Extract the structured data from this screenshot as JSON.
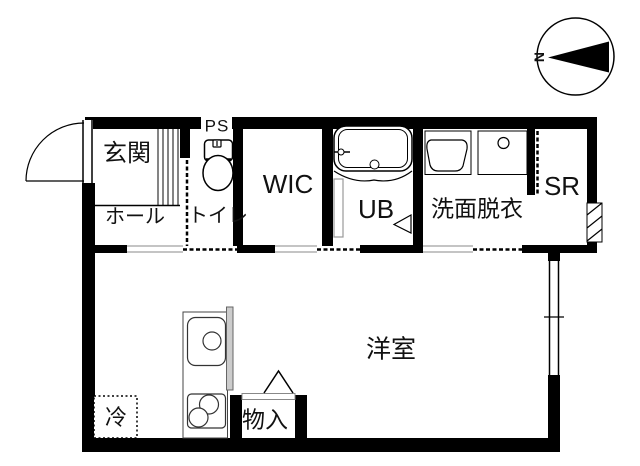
{
  "plan": {
    "type": "apartment-floor-plan",
    "colors": {
      "wall": "#000000",
      "background": "#ffffff",
      "fixture_line": "#333333",
      "counter_fill": "#cccccc",
      "opening_line": "#888888"
    },
    "rooms": {
      "genkan": "玄関",
      "hall": "ホール",
      "toilet": "トイレ",
      "ps": "PS",
      "wic": "WIC",
      "ub": "UB",
      "washroom": "洗面脱衣",
      "sr": "SR",
      "main_room": "洋室",
      "storage": "物入",
      "fridge": "冷"
    },
    "compass": {
      "north_label": "N",
      "direction": "needle-points-left"
    },
    "fixtures": [
      "entrance-swing-door",
      "toilet",
      "bathtub",
      "vanity-sink",
      "washing-machine-pan",
      "kitchen-sink",
      "two-burner-stove",
      "refrigerator-space",
      "sliding-doors",
      "window"
    ]
  }
}
